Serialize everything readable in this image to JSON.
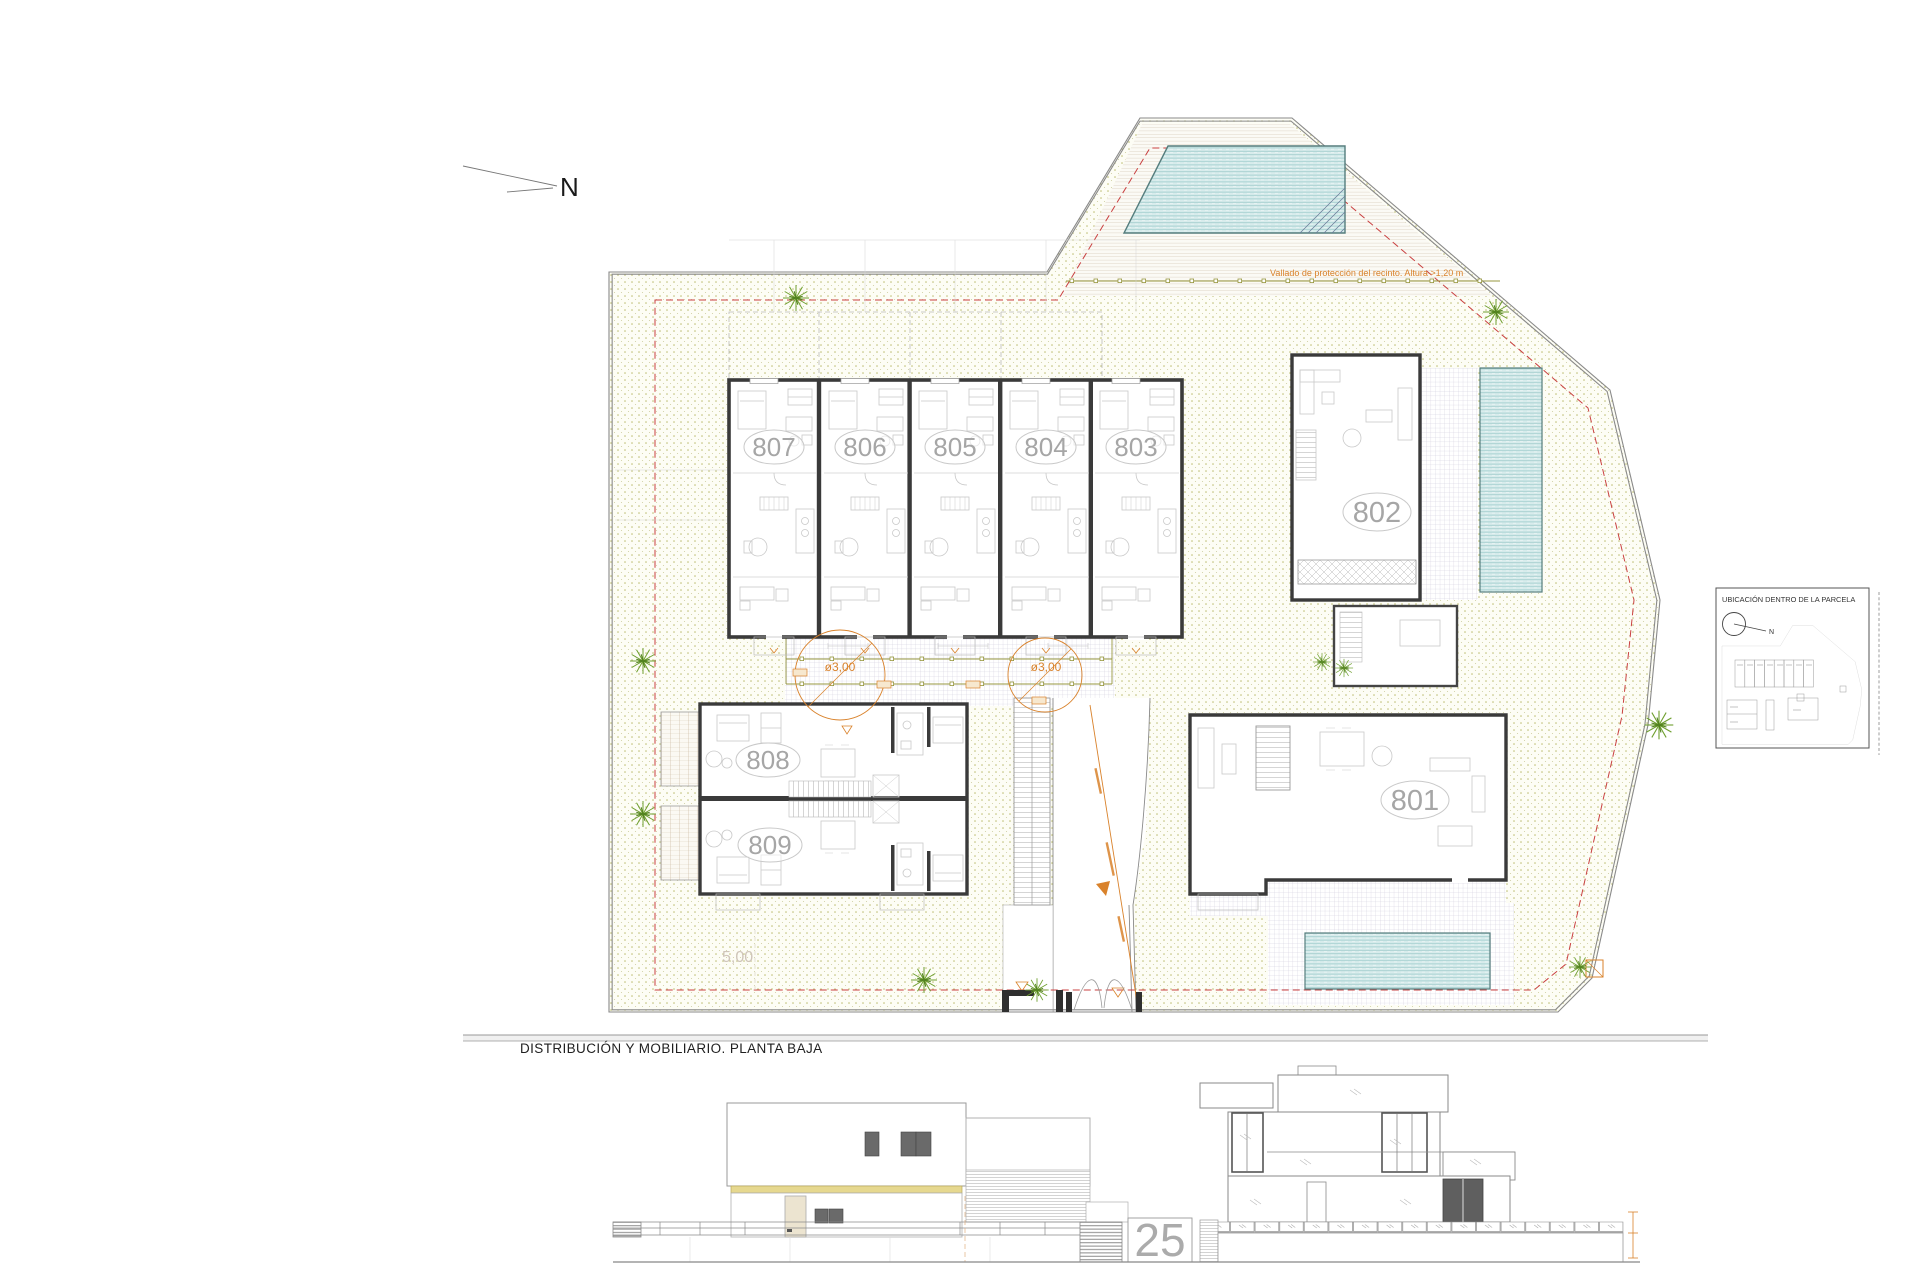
{
  "drawing": {
    "north_label": "N",
    "plan_title": "DISTRIBUCIÓN Y MOBILIARIO. PLANTA BAJA",
    "fence_note": "Vallado de protección del recinto. Altura >1,20 m",
    "setback_label": "5,00",
    "street_number": "25",
    "circle_dim_1": "ø3,00",
    "circle_dim_2": "ø3,00"
  },
  "units": [
    {
      "label": "807"
    },
    {
      "label": "806"
    },
    {
      "label": "805"
    },
    {
      "label": "804"
    },
    {
      "label": "803"
    },
    {
      "label": "802"
    },
    {
      "label": "801"
    },
    {
      "label": "808"
    },
    {
      "label": "809"
    }
  ],
  "legend": {
    "title": "UBICACIÓN DENTRO DE LA PARCELA",
    "north_label": "N"
  },
  "colors": {
    "wall": "#3a3a3a",
    "accent_orange": "#d9822b",
    "setback_red": "#c94040",
    "fence_olive": "#97973f",
    "water": "#d8ecec",
    "vegetation": "#6f9f2f",
    "slab_yellow": "#e6d88f"
  }
}
